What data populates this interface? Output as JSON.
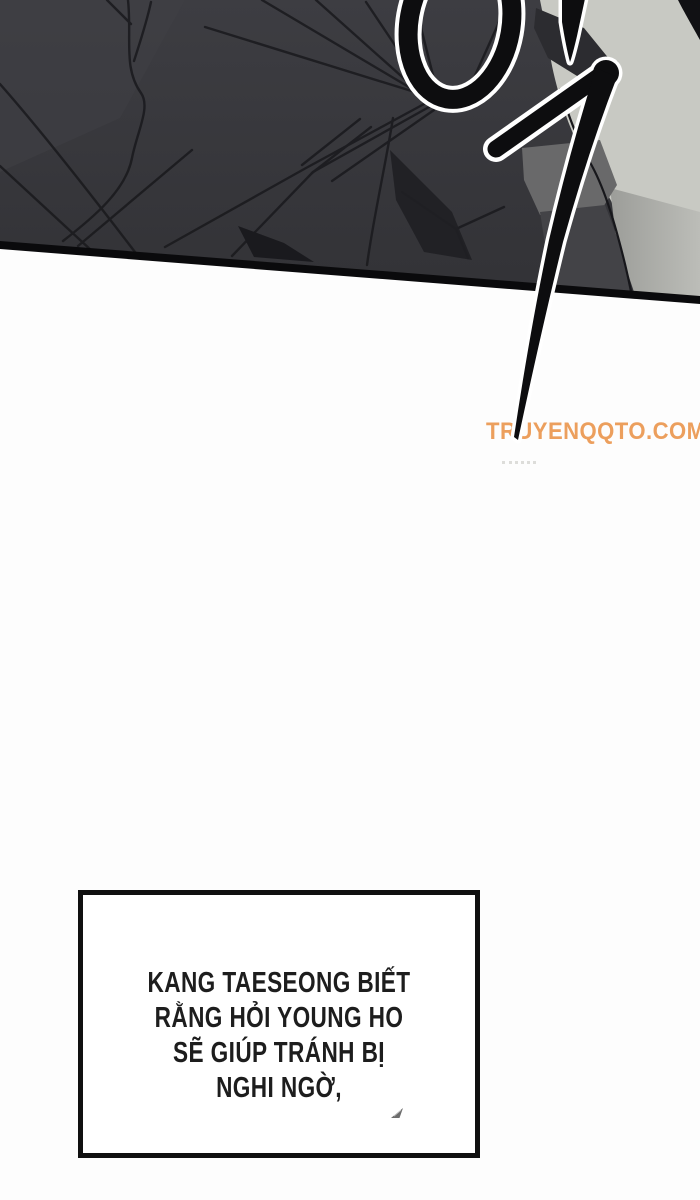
{
  "watermark": {
    "text": "TRUYENQQTO.COM"
  },
  "dialog": {
    "lines": [
      "KANG TAESEONG BIẾT",
      "RẰNG HỎI YOUNG HO",
      "SẼ GIÚP TRÁNH BỊ",
      "NGHI NGỜ,"
    ]
  },
  "icons": {
    "sfx": "korean-brush-sfx-stroke",
    "stray_mark": "quill-mark-icon"
  },
  "colors": {
    "page_bg": "#fdfdfd",
    "panel_charcoal": "#3a3a3e",
    "panel_charcoal_dark": "#323236",
    "panel_light": "#c8c9c3",
    "panel_mid": "#69696a",
    "panel_low_dark": "#434347",
    "panel_shadow": "#a5a6a1",
    "fold_ink": "#1b1b1f",
    "border_ink": "#0a0a0c",
    "sfx_ink": "#0d0d0f",
    "halo_white": "#ffffff",
    "watermark_orange": "#ec9a55",
    "dialog_border": "#101010",
    "dialog_text": "#1d1d1d"
  }
}
